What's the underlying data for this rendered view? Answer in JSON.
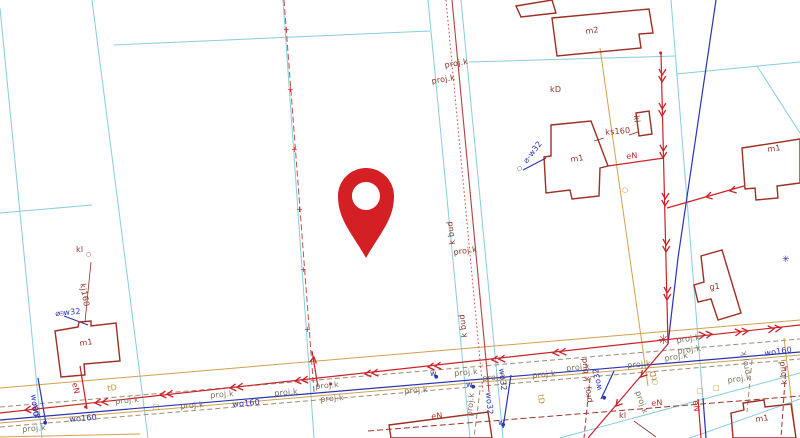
{
  "map": {
    "type": "cadastral-base-map",
    "marker": {
      "name": "location-pin",
      "color": "#d41f24"
    },
    "colors": {
      "background": "#ffffff",
      "parcel_boundary": "#85cde0",
      "building_outline": "#9e2f23",
      "power_line": "#cb2127",
      "water_line": "#2a35b5",
      "utility_orange": "#d3a04c",
      "projected_line": "#9b8c72",
      "projected_cable": "#b0413e"
    },
    "labels": [
      {
        "t": "proj.k",
        "x": 444,
        "y": 62,
        "c": "darkred",
        "r": -10
      },
      {
        "t": "proj.k",
        "x": 431,
        "y": 78,
        "c": "darkred",
        "r": -10
      },
      {
        "t": "m2",
        "x": 585,
        "y": 28,
        "c": "darkred",
        "r": -8
      },
      {
        "t": "kD",
        "x": 550,
        "y": 86,
        "c": "darkred",
        "r": 0
      },
      {
        "t": "ks160",
        "x": 605,
        "y": 129,
        "c": "darkred",
        "r": -5
      },
      {
        "t": "kl",
        "x": 640,
        "y": 115,
        "c": "darkred",
        "r": 85
      },
      {
        "t": "m1",
        "x": 570,
        "y": 156,
        "c": "darkred",
        "r": -8
      },
      {
        "t": "⌀-w32",
        "x": 522,
        "y": 160,
        "c": "blue",
        "r": -52
      },
      {
        "t": "eN",
        "x": 626,
        "y": 153,
        "c": "red",
        "r": -5
      },
      {
        "t": "m1",
        "x": 767,
        "y": 146,
        "c": "darkred",
        "r": -8
      },
      {
        "t": "g1",
        "x": 709,
        "y": 284,
        "c": "darkred",
        "r": -8
      },
      {
        "t": "kl",
        "x": 76,
        "y": 246,
        "c": "darkred",
        "r": 0
      },
      {
        "t": "kj160",
        "x": 86,
        "y": 283,
        "c": "darkred",
        "r": 80
      },
      {
        "t": "⌀-w32",
        "x": 55,
        "y": 310,
        "c": "blue",
        "r": -5
      },
      {
        "t": "m1",
        "x": 79,
        "y": 340,
        "c": "darkred",
        "r": -8
      },
      {
        "t": "eN",
        "x": 78,
        "y": 382,
        "c": "red",
        "r": 78
      },
      {
        "t": "tD",
        "x": 107,
        "y": 385,
        "c": "orange",
        "r": -5
      },
      {
        "t": "wo80",
        "x": 37,
        "y": 394,
        "c": "blue",
        "r": 84
      },
      {
        "t": "w",
        "x": 34,
        "y": 412,
        "c": "blue",
        "r": 0
      },
      {
        "t": "wo160",
        "x": 69,
        "y": 416,
        "c": "blue",
        "r": -5
      },
      {
        "t": "proj.k",
        "x": 22,
        "y": 426,
        "c": "gray",
        "r": -5
      },
      {
        "t": "proj.k",
        "x": 115,
        "y": 398,
        "c": "gray",
        "r": -5
      },
      {
        "t": "proj.k",
        "x": 180,
        "y": 403,
        "c": "gray",
        "r": -5
      },
      {
        "t": "wo160",
        "x": 232,
        "y": 401,
        "c": "blue",
        "r": -5
      },
      {
        "t": "proj.k",
        "x": 210,
        "y": 392,
        "c": "gray",
        "r": -5
      },
      {
        "t": "proj.k",
        "x": 274,
        "y": 390,
        "c": "gray",
        "r": -5
      },
      {
        "t": "proj.k",
        "x": 315,
        "y": 383,
        "c": "gray",
        "r": -5
      },
      {
        "t": "proj.k",
        "x": 320,
        "y": 396,
        "c": "gray",
        "r": -5
      },
      {
        "t": "k bud",
        "x": 449,
        "y": 245,
        "c": "darkred",
        "r": -97
      },
      {
        "t": "proj.k",
        "x": 453,
        "y": 249,
        "c": "darkred",
        "r": -8
      },
      {
        "t": "k bud",
        "x": 461,
        "y": 338,
        "c": "darkred",
        "r": -97
      },
      {
        "t": "proj.k",
        "x": 404,
        "y": 388,
        "c": "gray",
        "r": -5
      },
      {
        "t": "w",
        "x": 430,
        "y": 370,
        "c": "blue",
        "r": 0
      },
      {
        "t": "proj.k",
        "x": 454,
        "y": 370,
        "c": "gray",
        "r": -5
      },
      {
        "t": "w",
        "x": 466,
        "y": 381,
        "c": "blue",
        "r": 0
      },
      {
        "t": "proj.k",
        "x": 482,
        "y": 375,
        "c": "gray",
        "r": -5
      },
      {
        "t": "wo32",
        "x": 505,
        "y": 368,
        "c": "blue",
        "r": 84
      },
      {
        "t": "proj.k",
        "x": 532,
        "y": 372,
        "c": "gray",
        "r": -5
      },
      {
        "t": "proj.k",
        "x": 566,
        "y": 365,
        "c": "gray",
        "r": -5
      },
      {
        "t": "proj. k bud",
        "x": 586,
        "y": 403,
        "c": "darkred",
        "r": -97
      },
      {
        "t": "eN",
        "x": 431,
        "y": 413,
        "c": "red",
        "r": -5
      },
      {
        "t": "proj.k",
        "x": 466,
        "y": 416,
        "c": "gray",
        "r": -85
      },
      {
        "t": "wo32",
        "x": 492,
        "y": 392,
        "c": "blue",
        "r": 86
      },
      {
        "t": "w",
        "x": 498,
        "y": 419,
        "c": "blue",
        "r": 0
      },
      {
        "t": "tD",
        "x": 544,
        "y": 394,
        "c": "orange",
        "r": 84
      },
      {
        "t": "kl",
        "x": 619,
        "y": 412,
        "c": "darkred",
        "r": 0
      },
      {
        "t": "proj.k",
        "x": 641,
        "y": 390,
        "c": "gray",
        "r": 70
      },
      {
        "t": "proj.k",
        "x": 676,
        "y": 337,
        "c": "gray",
        "r": -8
      },
      {
        "t": "proj.k",
        "x": 677,
        "y": 348,
        "c": "gray",
        "r": -8
      },
      {
        "t": "proj.k",
        "x": 664,
        "y": 355,
        "c": "gray",
        "r": -8
      },
      {
        "t": "proj.k",
        "x": 627,
        "y": 362,
        "c": "gray",
        "r": -5
      },
      {
        "t": "proj.k",
        "x": 727,
        "y": 377,
        "c": "gray",
        "r": -8
      },
      {
        "t": "proj.k",
        "x": 744,
        "y": 375,
        "c": "gray",
        "r": -100
      },
      {
        "t": "wo160",
        "x": 764,
        "y": 350,
        "c": "blue",
        "r": -8
      },
      {
        "t": "k bud",
        "x": 781,
        "y": 385,
        "c": "darkred",
        "r": -97
      },
      {
        "t": "wo32",
        "x": 596,
        "y": 391,
        "c": "blue",
        "r": -100
      },
      {
        "t": "eN",
        "x": 651,
        "y": 400,
        "c": "red",
        "r": -5
      },
      {
        "t": "eN",
        "x": 699,
        "y": 400,
        "c": "red",
        "r": 84
      },
      {
        "t": "tD",
        "x": 651,
        "y": 381,
        "c": "orange",
        "r": -100
      },
      {
        "t": "m1",
        "x": 755,
        "y": 416,
        "c": "darkred",
        "r": -8
      }
    ],
    "symbols": [
      {
        "n": "water-valve-dot",
        "g": "●",
        "x": 43,
        "y": 421,
        "c": "blue",
        "s": 5
      },
      {
        "n": "water-valve-dot",
        "g": "●",
        "x": 434,
        "y": 375,
        "c": "blue",
        "s": 5
      },
      {
        "n": "water-valve-dot",
        "g": "●",
        "x": 471,
        "y": 385,
        "c": "blue",
        "s": 5
      },
      {
        "n": "water-valve-dot",
        "g": "●",
        "x": 501,
        "y": 423,
        "c": "blue",
        "s": 5
      },
      {
        "n": "water-valve-dot",
        "g": "●",
        "x": 602,
        "y": 396,
        "c": "blue",
        "s": 5
      },
      {
        "n": "water-connection-circle",
        "g": "○",
        "x": 59,
        "y": 311,
        "c": "blue",
        "s": 6
      },
      {
        "n": "water-connection-circle",
        "g": "○",
        "x": 517,
        "y": 166,
        "c": "blue",
        "s": 6
      },
      {
        "n": "manhole-circle",
        "g": "○",
        "x": 86,
        "y": 252,
        "c": "darkred",
        "s": 6
      },
      {
        "n": "lamp-circle",
        "g": "○",
        "x": 622,
        "y": 187,
        "c": "orange",
        "s": 7
      },
      {
        "n": "lamp-circle",
        "g": "○",
        "x": 652,
        "y": 379,
        "c": "orange",
        "s": 7
      },
      {
        "n": "junction-node-star",
        "g": "✳",
        "x": 658,
        "y": 334,
        "c": "red",
        "s": 13
      },
      {
        "n": "survey-marker-asterisk",
        "g": "✳",
        "x": 782,
        "y": 256,
        "c": "blue",
        "s": 9
      },
      {
        "n": "boundary-cross",
        "g": "+",
        "x": 283,
        "y": 26,
        "c": "red",
        "s": 8
      },
      {
        "n": "boundary-cross",
        "g": "+",
        "x": 287,
        "y": 86,
        "c": "red",
        "s": 8
      },
      {
        "n": "boundary-cross",
        "g": "+",
        "x": 291,
        "y": 146,
        "c": "red",
        "s": 8
      },
      {
        "n": "boundary-cross",
        "g": "+",
        "x": 296,
        "y": 206,
        "c": "red",
        "s": 8
      },
      {
        "n": "boundary-cross",
        "g": "+",
        "x": 300,
        "y": 266,
        "c": "red",
        "s": 8
      },
      {
        "n": "boundary-cross",
        "g": "+",
        "x": 304,
        "y": 326,
        "c": "red",
        "s": 8
      },
      {
        "n": "connection-dot",
        "g": "●",
        "x": 84,
        "y": 405,
        "c": "red",
        "s": 4
      },
      {
        "n": "connection-dot",
        "g": "●",
        "x": 329,
        "y": 382,
        "c": "red",
        "s": 4
      },
      {
        "n": "connection-dot",
        "g": "●",
        "x": 659,
        "y": 51,
        "c": "red",
        "s": 4
      },
      {
        "n": "utility-box",
        "g": "□",
        "x": 153,
        "y": 404,
        "c": "orange",
        "s": 7
      },
      {
        "n": "utility-box",
        "g": "□",
        "x": 697,
        "y": 388,
        "c": "orange",
        "s": 7
      },
      {
        "n": "utility-box",
        "g": "□",
        "x": 713,
        "y": 385,
        "c": "orange",
        "s": 7
      }
    ]
  }
}
